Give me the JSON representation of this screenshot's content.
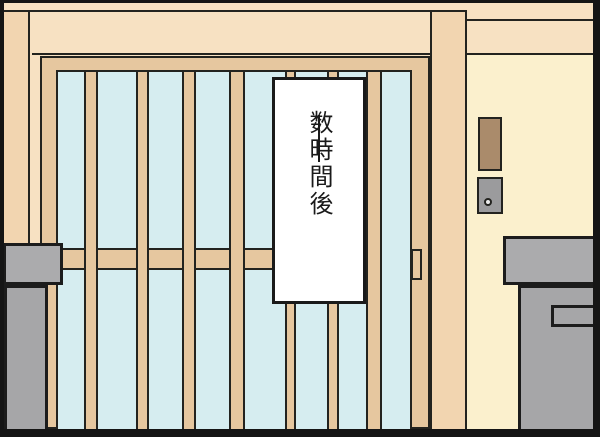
{
  "caption": {
    "text": "数時間後",
    "dash_glyph": "―",
    "meaning": "caption banner on sliding door"
  },
  "colors": {
    "wall_peach": "#f7e1c2",
    "pillar_peach": "#f2d5b0",
    "door_tan": "#e6c79f",
    "glass_blue": "#d6edf0",
    "entrance_cream": "#fbf0cd",
    "fixture_brown": "#aa8b6b",
    "metal_gray": "#a6a6a8",
    "metal_gray_light": "#ababad",
    "outline_black": "#23231f",
    "banner_white": "#ffffff"
  }
}
